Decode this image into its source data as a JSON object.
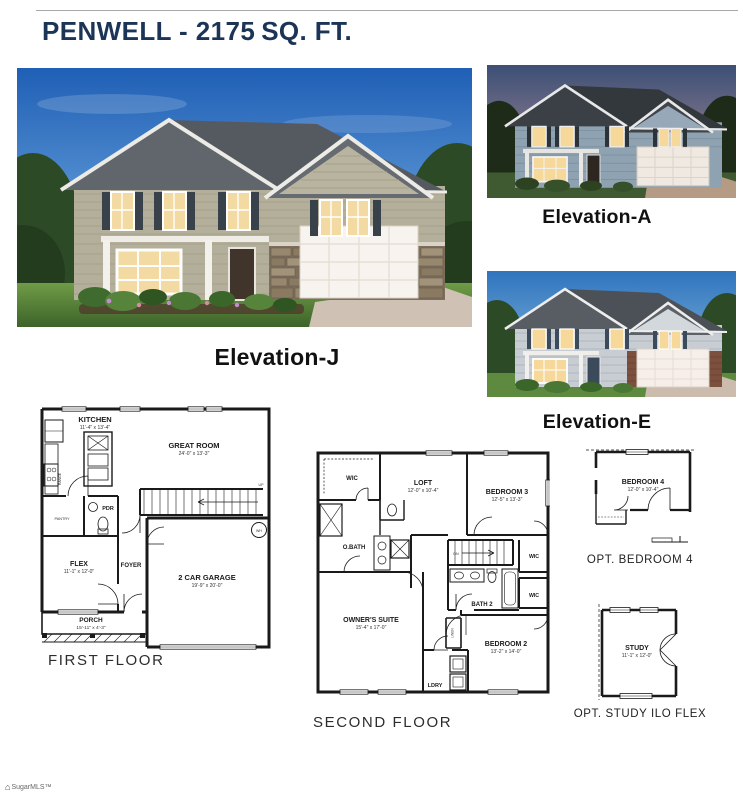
{
  "page": {
    "title_main": "PENWELL - 2175",
    "title_suffix": "SQ. FT.",
    "title_color": "#1c3557",
    "watermark": "SugarMLS™"
  },
  "elevations": {
    "j": "Elevation-J",
    "a": "Elevation-A",
    "e": "Elevation-E"
  },
  "first_floor": {
    "caption": "FIRST FLOOR",
    "kitchen": {
      "name": "KITCHEN",
      "dims": "11'-4\" x 13'-4\""
    },
    "great_room": {
      "name": "GREAT ROOM",
      "dims": "24'-0\" x 13'-3\""
    },
    "pantry": "PANTRY",
    "range": "RANGE",
    "pdr": "PDR",
    "flex": {
      "name": "FLEX",
      "dims": "11'-1\" x 12'-0\""
    },
    "foyer": "FOYER",
    "garage": {
      "name": "2 CAR GARAGE",
      "dims": "19'-9\" x 20'-0\""
    },
    "porch": {
      "name": "PORCH",
      "dims": "15'-11\" x 4'-3\""
    },
    "up": "UP",
    "wh": "WH"
  },
  "second_floor": {
    "caption": "SECOND FLOOR",
    "wic_owner": "WIC",
    "loft": {
      "name": "LOFT",
      "dims": "12'-0\" x 10'-4\""
    },
    "bedroom3": {
      "name": "BEDROOM 3",
      "dims": "12'-5\" x 13'-3\""
    },
    "obath": "O.BATH",
    "wic_b3": "WIC",
    "wic_b2": "WIC",
    "bath2": "BATH 2",
    "owners": {
      "name": "OWNER'S SUITE",
      "dims": "15'-4\" x 17'-0\""
    },
    "bedroom2": {
      "name": "BEDROOM 2",
      "dims": "13'-2\" x 14'-0\""
    },
    "ldry": "LDRY",
    "dn": "DN",
    "linen": "LINEN"
  },
  "options": {
    "bedroom4": {
      "name": "BEDROOM 4",
      "dims": "12'-0\" x 10'-4\"",
      "caption": "OPT. BEDROOM 4"
    },
    "study": {
      "name": "STUDY",
      "dims": "11'-1\" x 12'-0\"",
      "caption": "OPT. STUDY ILO FLEX"
    }
  }
}
